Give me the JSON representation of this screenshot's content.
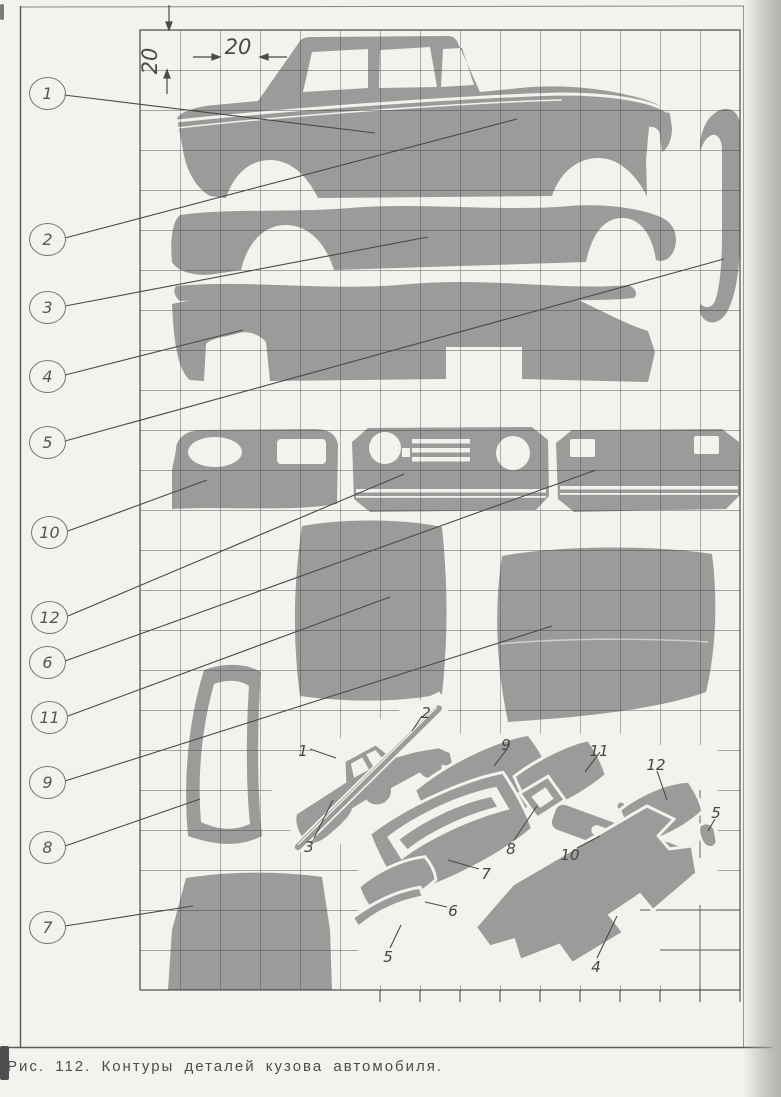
{
  "page": {
    "caption": "Рис. 112. Контуры деталей кузова автомобиля."
  },
  "colors": {
    "paper": "#f3f2ee",
    "part_gray": "#9c9b99",
    "grid_ink": "#3c3c3c",
    "label_ink": "#4a4a4a"
  },
  "grid": {
    "cell_label_horizontal": "20",
    "cell_label_vertical": "20"
  },
  "callouts": [
    {
      "num": "1"
    },
    {
      "num": "2"
    },
    {
      "num": "3"
    },
    {
      "num": "4"
    },
    {
      "num": "5"
    },
    {
      "num": "10"
    },
    {
      "num": "12"
    },
    {
      "num": "6"
    },
    {
      "num": "11"
    },
    {
      "num": "9"
    },
    {
      "num": "8"
    },
    {
      "num": "7"
    }
  ],
  "exploded": {
    "labels": [
      {
        "text": "1"
      },
      {
        "text": "2"
      },
      {
        "text": "3"
      },
      {
        "text": "9"
      },
      {
        "text": "11"
      },
      {
        "text": "12"
      },
      {
        "text": "5"
      },
      {
        "text": "8"
      },
      {
        "text": "10"
      },
      {
        "text": "7"
      },
      {
        "text": "6"
      },
      {
        "text": "5"
      },
      {
        "text": "4"
      }
    ]
  }
}
